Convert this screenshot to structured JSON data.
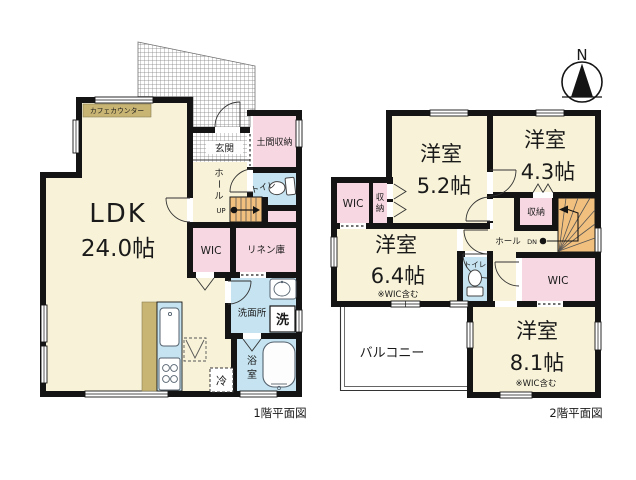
{
  "compass": {
    "north_label": "N"
  },
  "floor1": {
    "caption": "1階平面図",
    "labels": {
      "ldk": "LDK",
      "ldk_size": "24.0帖",
      "cafe_counter": "カフェカウンター",
      "genkan": "玄関",
      "doma_storage": "土間収納",
      "toilet": "トイレ",
      "hall_chars": [
        "ホ",
        "ー",
        "ル"
      ],
      "up": "UP",
      "wic": "WIC",
      "linen": "リネン庫",
      "washroom": "洗面所",
      "washer": "洗",
      "bath_chars": [
        "浴",
        "室"
      ],
      "fridge": "冷"
    }
  },
  "floor2": {
    "caption": "2階平面図",
    "labels": {
      "room52": [
        "洋室",
        "5.2帖"
      ],
      "room43": [
        "洋室",
        "4.3帖"
      ],
      "room64": [
        "洋室",
        "6.4帖",
        "※WIC含む"
      ],
      "room81": [
        "洋室",
        "8.1帖",
        "※WIC含む"
      ],
      "wic_left": "WIC",
      "closet_left_chars": [
        "収",
        "納"
      ],
      "closet_mid": "収納",
      "hall": "ホール",
      "down": "DN",
      "toilet": "トイレ",
      "wic_right": "WIC",
      "balcony": "バルコニー"
    }
  },
  "colors": {
    "floor_yellow": "#F8F3D8",
    "closet_pink": "#F6D7E2",
    "wet_blue": "#C5E3F0",
    "stairs_orange": "#F2C07E",
    "counter_tan": "#C9B573",
    "wall_black": "#141414",
    "balcony_white": "#FFFFFF"
  }
}
